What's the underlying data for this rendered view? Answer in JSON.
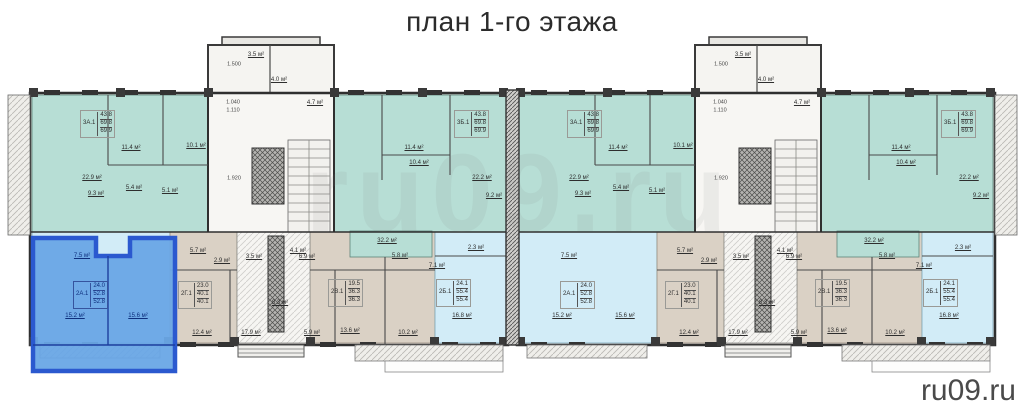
{
  "title": "план 1-го этажа",
  "watermark": "ru09.ru",
  "colors": {
    "teal_unit": "#b7ded5",
    "beige_unit": "#dad1c5",
    "lightblue_unit": "#d2ecf7",
    "highlight_fill": "#69a7e6",
    "highlight_border": "#2b59cf",
    "wall": "#2f2f2f",
    "title_color": "#2b2b2b",
    "watermark_color": "#4a4a4a"
  },
  "buildings": [
    {
      "x": 30,
      "has_highlight": true
    },
    {
      "x": 517,
      "has_highlight": false
    }
  ],
  "apartments": [
    {
      "type": "3А.1",
      "values": [
        "43.8",
        "69.8",
        "69.9"
      ],
      "color": "teal",
      "stamp": {
        "x": 50,
        "y": 110
      }
    },
    {
      "type": "3Б.1",
      "values": [
        "43.8",
        "69.8",
        "69.9"
      ],
      "color": "teal",
      "stamp": {
        "x": 424,
        "y": 110
      }
    },
    {
      "type": "2А.1",
      "values": [
        "24.0",
        "52.8",
        "52.8"
      ],
      "color": "lightblue",
      "zone": "a1",
      "stamp": {
        "x": 43,
        "y": 281
      }
    },
    {
      "type": "2Г.1",
      "values": [
        "23.0",
        "40.1",
        "40.1"
      ],
      "color": "beige",
      "stamp": {
        "x": 148,
        "y": 281
      }
    },
    {
      "type": "2В.1",
      "values": [
        "19.5",
        "36.3",
        "36.3"
      ],
      "color": "beige",
      "stamp": {
        "x": 298,
        "y": 279
      }
    },
    {
      "type": "2Б.1",
      "values": [
        "24.1",
        "55.4",
        "55.4"
      ],
      "color": "lightblue",
      "stamp": {
        "x": 406,
        "y": 279
      }
    }
  ],
  "room_labels": [
    {
      "t": "11.4 м²",
      "x": 101,
      "y": 148,
      "cls": "area"
    },
    {
      "t": "10.1 м²",
      "x": 166,
      "y": 146,
      "cls": "area"
    },
    {
      "t": "22.9 м²",
      "x": 62,
      "y": 178,
      "cls": "area"
    },
    {
      "t": "9.3 м²",
      "x": 66,
      "y": 194,
      "cls": "area"
    },
    {
      "t": "5.4 м²",
      "x": 104,
      "y": 188,
      "cls": "area"
    },
    {
      "t": "5.1 м²",
      "x": 140,
      "y": 191,
      "cls": "area"
    },
    {
      "t": "3.5 м²",
      "x": 226,
      "y": 55,
      "cls": "area"
    },
    {
      "t": "1.500",
      "x": 204,
      "y": 65,
      "cls": "dim"
    },
    {
      "t": "4.0 м²",
      "x": 249,
      "y": 80,
      "cls": "area"
    },
    {
      "t": "4.7 м²",
      "x": 285,
      "y": 103,
      "cls": "area"
    },
    {
      "t": "1.040",
      "x": 203,
      "y": 103,
      "cls": "dim"
    },
    {
      "t": "1.110",
      "x": 203,
      "y": 111,
      "cls": "dim"
    },
    {
      "t": "1.920",
      "x": 204,
      "y": 179,
      "cls": "dim"
    },
    {
      "t": "11.4 м²",
      "x": 384,
      "y": 148,
      "cls": "area"
    },
    {
      "t": "10.4 м²",
      "x": 389,
      "y": 163,
      "cls": "area"
    },
    {
      "t": "32.2 м²",
      "x": 357,
      "y": 241,
      "cls": "area"
    },
    {
      "t": "22.2 м²",
      "x": 452,
      "y": 178,
      "cls": "area"
    },
    {
      "t": "9.2 м²",
      "x": 464,
      "y": 196,
      "cls": "area"
    },
    {
      "t": "7.5 м²",
      "x": 52,
      "y": 256,
      "cls": "area",
      "zone": "a1"
    },
    {
      "t": "15.2 м²",
      "x": 45,
      "y": 316,
      "cls": "area",
      "zone": "a1"
    },
    {
      "t": "15.6 м²",
      "x": 108,
      "y": 316,
      "cls": "area",
      "zone": "a1"
    },
    {
      "t": "5.7 м²",
      "x": 168,
      "y": 251,
      "cls": "area"
    },
    {
      "t": "2.9 м²",
      "x": 192,
      "y": 261,
      "cls": "area"
    },
    {
      "t": "3.5 м²",
      "x": 224,
      "y": 257,
      "cls": "area"
    },
    {
      "t": "4.1 м²",
      "x": 268,
      "y": 251,
      "cls": "area"
    },
    {
      "t": "12.4 м²",
      "x": 172,
      "y": 333,
      "cls": "area"
    },
    {
      "t": "17.9 м²",
      "x": 221,
      "y": 333,
      "cls": "area"
    },
    {
      "t": "8.3 м²",
      "x": 250,
      "y": 303,
      "cls": "area"
    },
    {
      "t": "6.9 м²",
      "x": 277,
      "y": 257,
      "cls": "area"
    },
    {
      "t": "5.9 м²",
      "x": 282,
      "y": 333,
      "cls": "area"
    },
    {
      "t": "13.6 м²",
      "x": 320,
      "y": 331,
      "cls": "area"
    },
    {
      "t": "10.2 м²",
      "x": 378,
      "y": 333,
      "cls": "area"
    },
    {
      "t": "16.8 м²",
      "x": 432,
      "y": 316,
      "cls": "area"
    },
    {
      "t": "7.1 м²",
      "x": 407,
      "y": 266,
      "cls": "area"
    },
    {
      "t": "5.8 м²",
      "x": 370,
      "y": 256,
      "cls": "area"
    },
    {
      "t": "2.3 м²",
      "x": 446,
      "y": 248,
      "cls": "area"
    }
  ]
}
